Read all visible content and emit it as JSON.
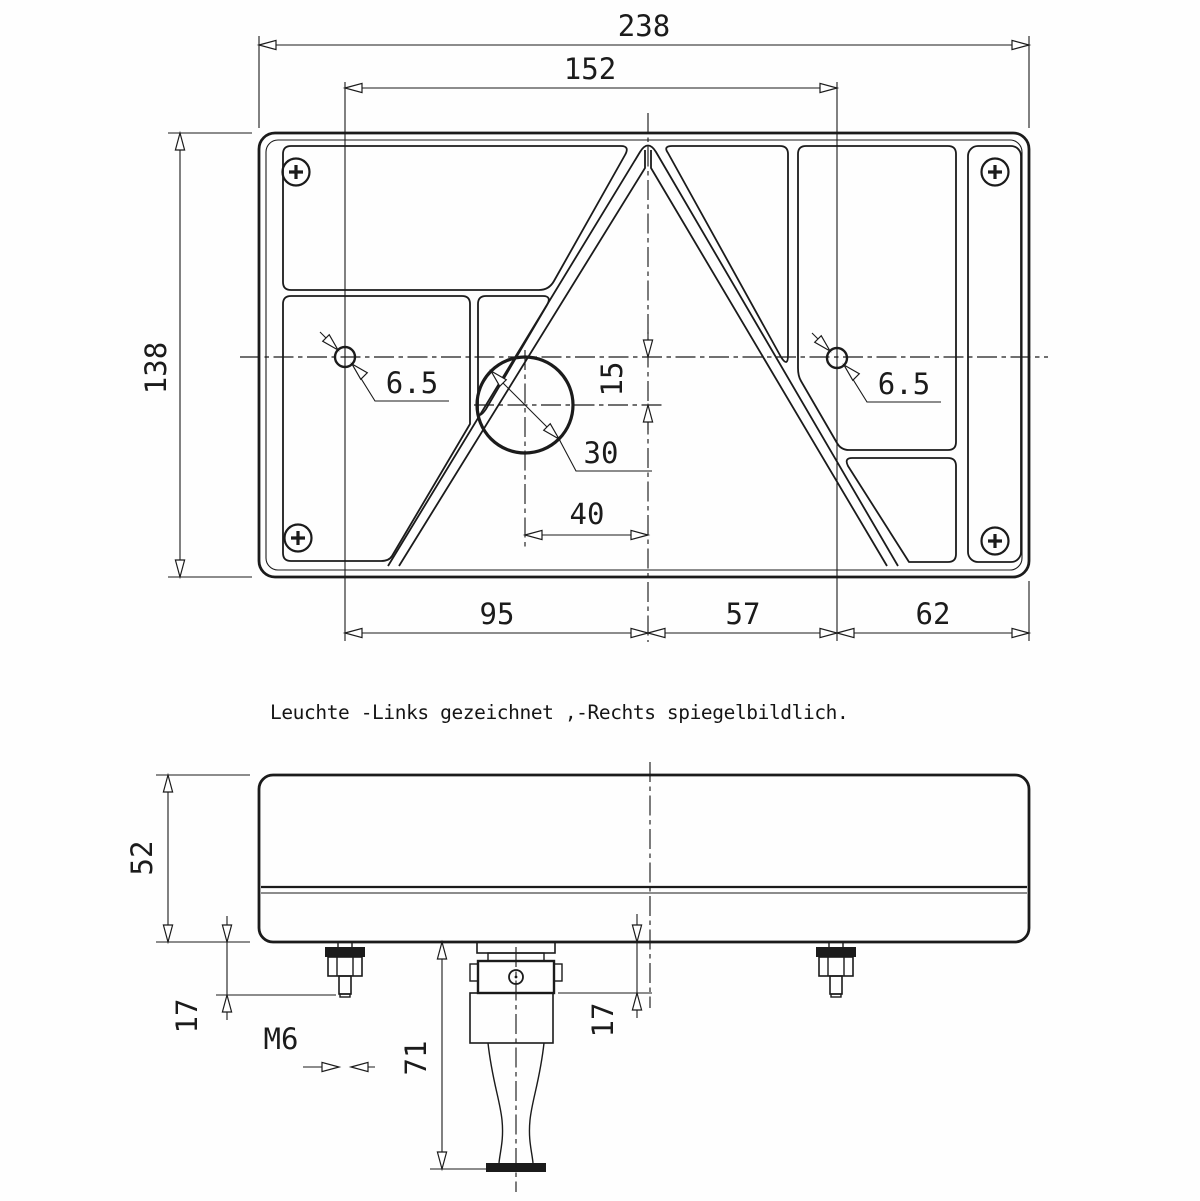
{
  "caption": "Leuchte -Links gezeichnet ,-Rechts spiegelbildlich.",
  "front_view": {
    "dim_width": "238",
    "dim_inner_width": "152",
    "dim_height": "138",
    "dim_hole_left": "6.5",
    "dim_hole_right": "6.5",
    "dim_center_offset": "15",
    "dim_gland_dia": "30",
    "dim_gland_x": "40",
    "dim_bottom_left": "95",
    "dim_bottom_mid": "57",
    "dim_bottom_right": "62"
  },
  "side_view": {
    "dim_height": "52",
    "dim_stud_left": "17",
    "dim_thread": "M6",
    "dim_connector": "71",
    "dim_stud_right": "17"
  },
  "colors": {
    "ink": "#1b1b1b",
    "paper": "#ffffff"
  }
}
